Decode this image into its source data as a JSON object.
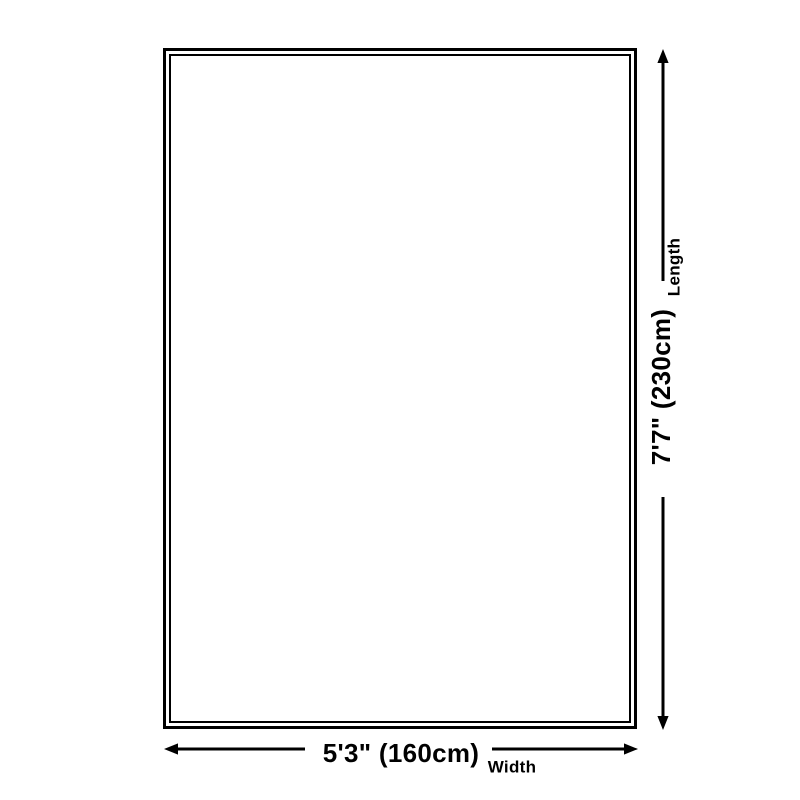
{
  "diagram": {
    "background_color": "#ffffff",
    "line_color": "#000000",
    "length": {
      "value": "7'7\" (230cm)",
      "label": "Length"
    },
    "width": {
      "value": "5'3\" (160cm)",
      "label": "Width"
    }
  }
}
